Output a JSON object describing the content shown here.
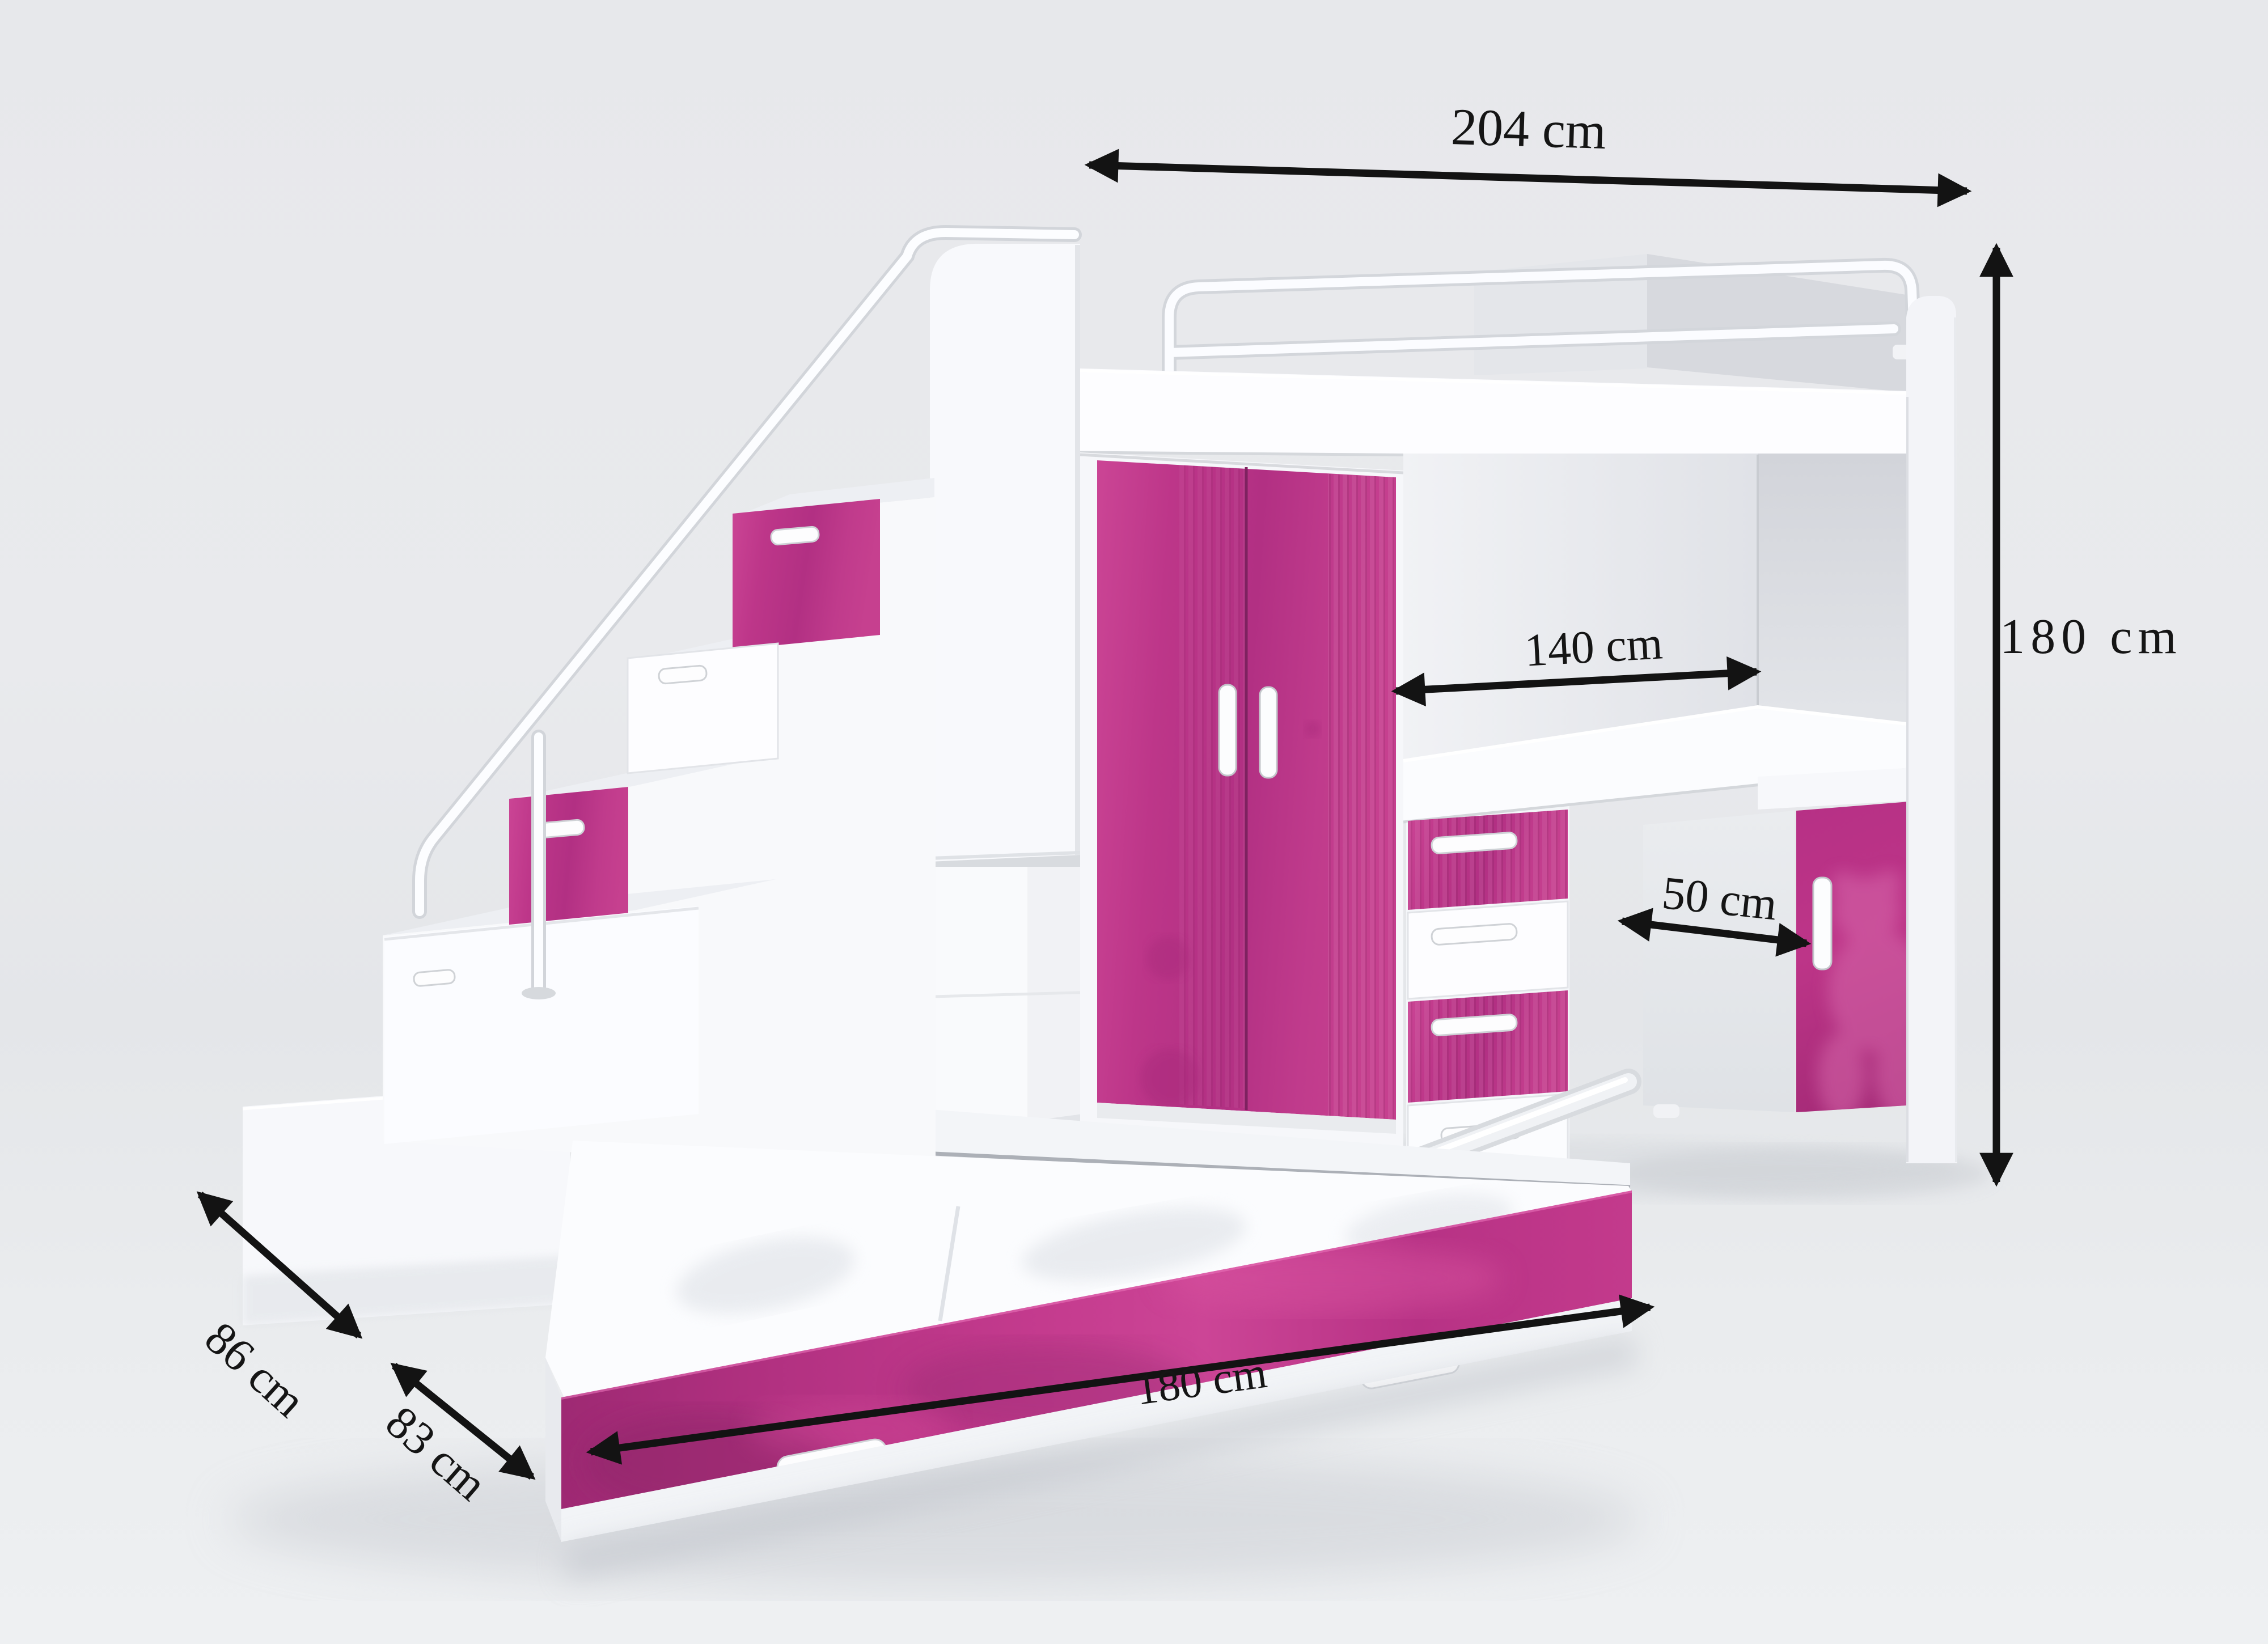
{
  "dimensions": {
    "overall_width": {
      "label": "204 cm"
    },
    "overall_height": {
      "label": "180 cm"
    },
    "inner_width": {
      "label": "140 cm"
    },
    "cabinet_width": {
      "label": "50 cm"
    },
    "upper_depth": {
      "label": "86 cm"
    },
    "lower_depth": {
      "label": "83 cm"
    },
    "bed_length": {
      "label": "180 cm"
    }
  },
  "colors": {
    "accent_pink": "#c23a8c",
    "furniture_white": "#f8f9fb",
    "dimension_black": "#141414",
    "background_gray": "#e8e9ec"
  }
}
